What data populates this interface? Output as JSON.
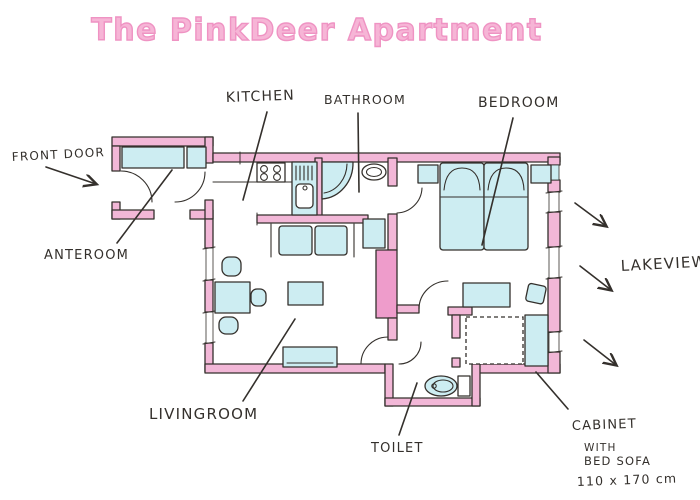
{
  "title": "The PinkDeer Apartment",
  "labels": {
    "front_door": "FRONT DOOR",
    "anteroom": "ANTEROOM",
    "kitchen": "KITCHEN",
    "bathroom": "BATHROOM",
    "bedroom": "BEDROOM",
    "lakeview": "LAKEVIEW",
    "livingroom": "LIVINGROOM",
    "toilet": "TOILET",
    "cabinet_line1": "CABINET",
    "cabinet_line2": "WITH",
    "cabinet_line3": "BED SOFA",
    "cabinet_dimensions": "110 x 170 cm"
  },
  "colors": {
    "title_pink": "#f6b5d6",
    "title_outline": "#ef93c3",
    "wall_pink": "#f2b7d7",
    "wall_pink_deep": "#ee9ccb",
    "furniture_blue": "#cdedf2",
    "ink": "#34302c",
    "paper": "#ffffff"
  }
}
